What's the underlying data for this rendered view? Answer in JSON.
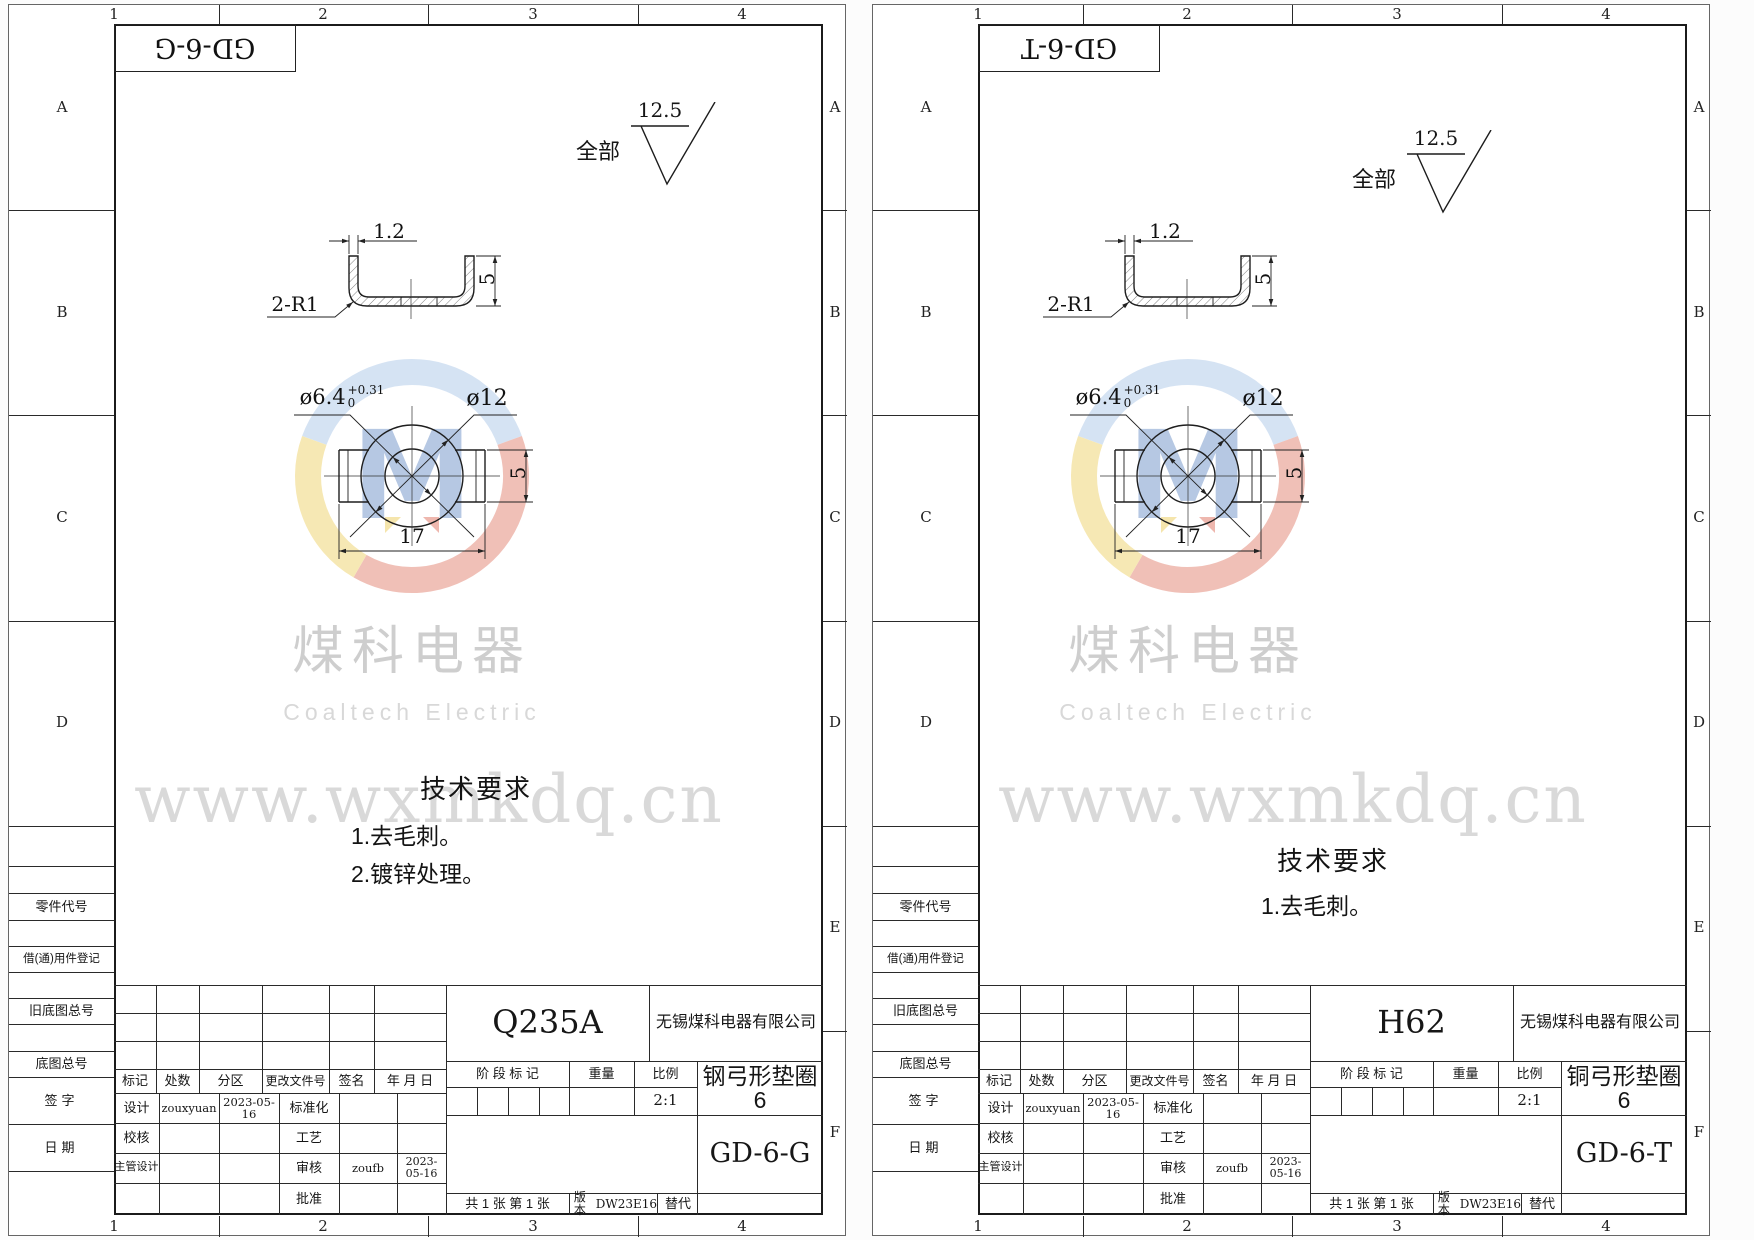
{
  "frame": {
    "cols": [
      "1",
      "2",
      "3",
      "4"
    ],
    "rows": [
      "A",
      "B",
      "C",
      "D",
      "E",
      "F"
    ]
  },
  "surface": {
    "finish": "12.5",
    "scope": "全部"
  },
  "dims": {
    "thickness": "1.2",
    "corner": "2-R1",
    "leg_height": "5",
    "hole": "ø6.4",
    "hole_tol_up": "+0.31",
    "hole_tol_dn": "0",
    "outer": "ø12",
    "total_width": "17",
    "tab_height": "5"
  },
  "watermark": {
    "cn": "煤科电器",
    "en": "Coaltech Electric",
    "url": "www.wxmkdq.cn",
    "logo_letter": "M"
  },
  "tech_title": "技术要求",
  "labels": {
    "part_code": "零件代号",
    "borrow_reg": "借(通)用件登记",
    "old_base_no": "旧底图总号",
    "base_no": "底图总号",
    "sign": "签字",
    "date": "日期",
    "mark": "标记",
    "count": "处数",
    "zone": "分区",
    "change_doc": "更改文件号",
    "signature": "签名",
    "ymd": "年 月 日",
    "design": "设计",
    "standardize": "标准化",
    "check": "校核",
    "process": "工艺",
    "chief_design": "主管设计",
    "audit": "审核",
    "approve": "批准",
    "stage_mark": "阶 段 标 记",
    "weight": "重量",
    "scale": "比例",
    "version_label": "版本",
    "replace_label": "替代"
  },
  "common": {
    "company": "无锡煤科电器有限公司",
    "scale_value": "2:1",
    "designer": "zouxyuan",
    "design_date": "2023-05-16",
    "auditor": "zoufb",
    "audit_date": "2023-05-16",
    "version": "DW23E16",
    "sheet_info": "共 1 张  第 1 张"
  },
  "sheets": [
    {
      "doc_no": "GD-6-G",
      "material": "Q235A",
      "part_name": "钢弓形垫圈6",
      "tech_items": [
        "1.去毛刺。",
        "2.镀锌处理。"
      ]
    },
    {
      "doc_no": "GD-6-T",
      "material": "H62",
      "part_name": "铜弓形垫圈6",
      "tech_items": [
        "1.去毛刺。"
      ]
    }
  ]
}
